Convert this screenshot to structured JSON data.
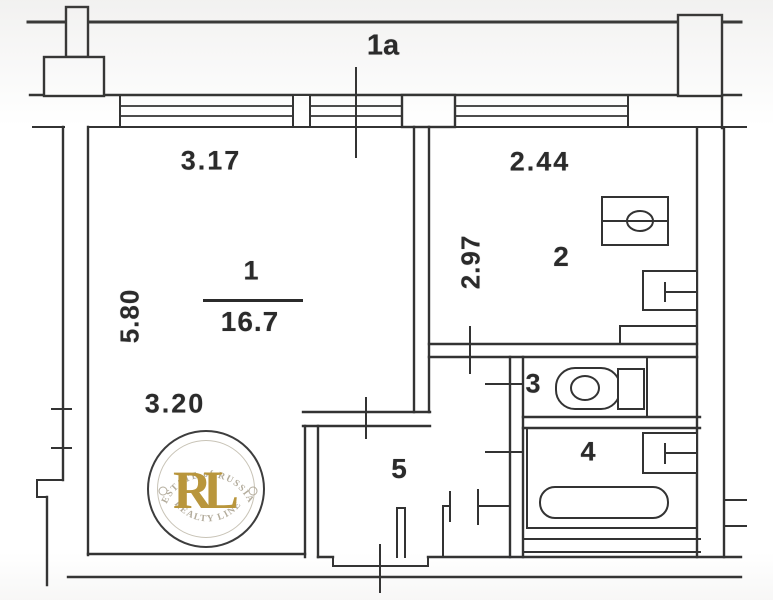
{
  "document": {
    "type": "apartment floor plan scan"
  },
  "colors": {
    "line": "#333333",
    "background": "#ffffff",
    "stamp_gold": "#b9963c",
    "stamp_arc_text": "#b3ac9c",
    "stamp_border": "#3d3d3d"
  },
  "rooms": {
    "balcony_label": "1a",
    "room1_number": "1",
    "room1_area": "16.7",
    "room2_number": "2",
    "room3_number": "3",
    "room4_number": "4",
    "room5_number": "5"
  },
  "dimensions": {
    "room1_width_top": "3.17",
    "room1_depth_left": "5.80",
    "room1_width_bottom": "3.20",
    "room2_width_top": "2.44",
    "room2_depth_left": "2.97"
  },
  "fixtures": [
    "stove-icon",
    "kitchen-sink-icon",
    "toilet-icon",
    "bathroom-sink-icon",
    "bathtub-icon"
  ],
  "watermark": {
    "arc_top": "ESTATE of RUSSIA",
    "initials": "RL",
    "arc_bottom": "REALTY LINE"
  }
}
